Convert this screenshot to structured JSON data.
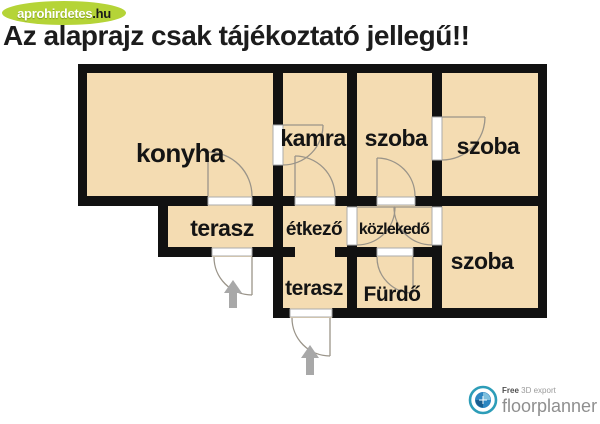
{
  "watermark": {
    "brand": "aprohirdetes",
    "tld": ".hu"
  },
  "title": "Az alaprajz csak tájékoztató jellegű!!",
  "rooms": {
    "konyha": "konyha",
    "kamra": "kamra",
    "szoba_top_middle": "szoba",
    "szoba_top_right": "szoba",
    "terasz_upper": "terasz",
    "etkezo": "étkező",
    "kozlekedo": "közlekedő",
    "terasz_lower": "terasz",
    "furdo": "Fürdő",
    "szoba_bottom_right": "szoba"
  },
  "logo": {
    "free": "Free",
    "export_text": "3D export",
    "brand": "floorplanner"
  },
  "colors": {
    "floor": "#f4dcb2",
    "wall": "#111111",
    "watermark_green": "#b5d437",
    "arrow_grey": "#a8a8a8",
    "logo_teal": "#2d9db8",
    "logo_blue": "#2e86c1"
  }
}
